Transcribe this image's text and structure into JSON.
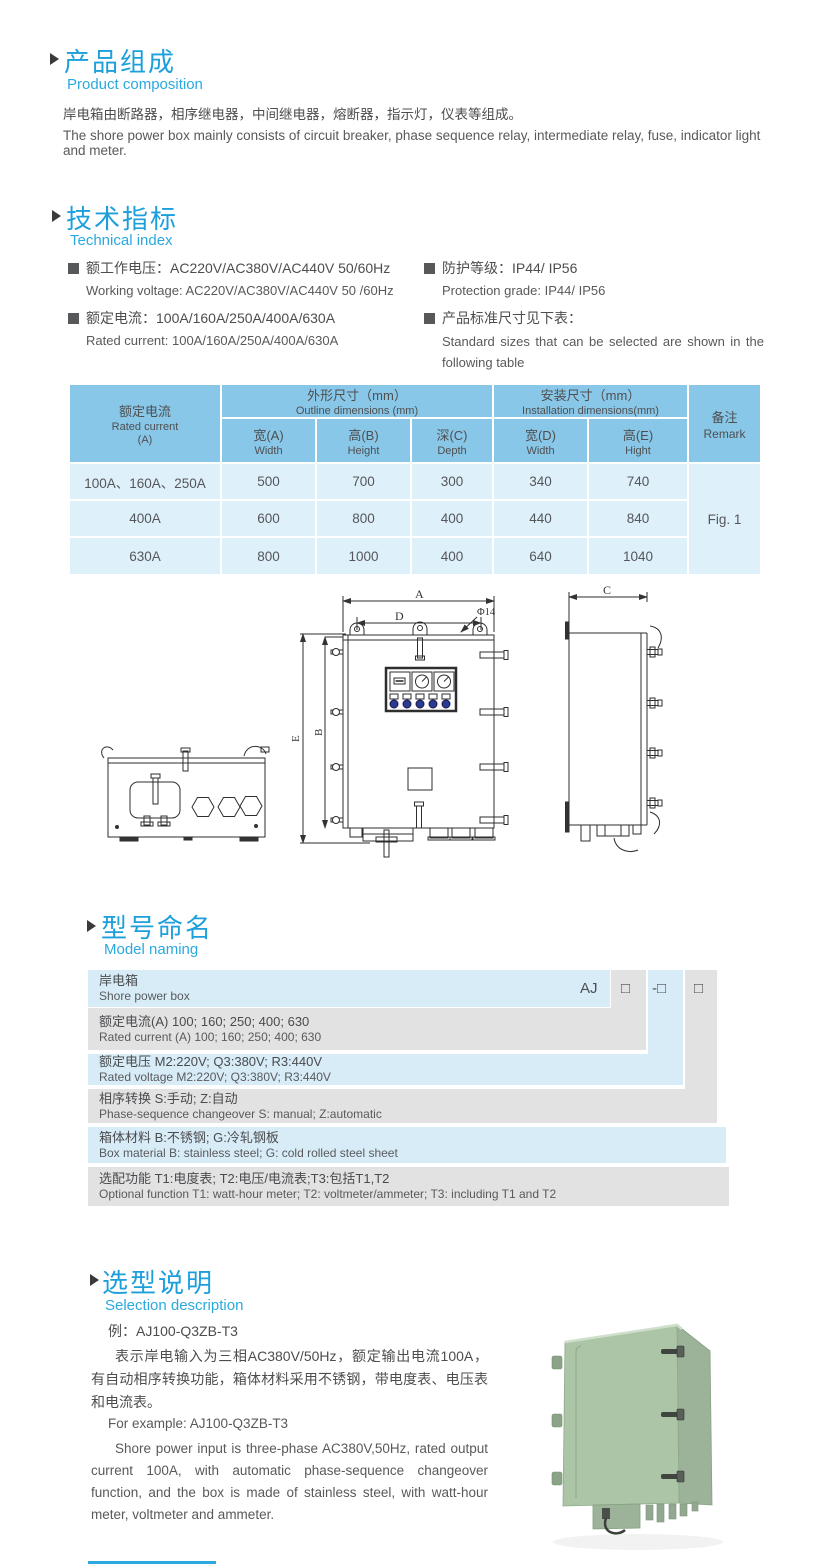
{
  "composition": {
    "title_cn": "产品组成",
    "title_en": "Product  composition",
    "body_cn": "岸电箱由断路器，相序继电器，中间继电器，熔断器，指示灯，仪表等组成。",
    "body_en": "The shore power box mainly consists of circuit breaker, phase sequence relay, intermediate relay, fuse, indicator light and meter."
  },
  "technical": {
    "title_cn": "技术指标",
    "title_en": "Technical index",
    "specs_left": [
      {
        "cn": "额工作电压：AC220V/AC380V/AC440V  50/60Hz",
        "en": "Working voltage: AC220V/AC380V/AC440V 50 /60Hz"
      },
      {
        "cn": "额定电流：100A/160A/250A/400A/630A",
        "en": "Rated current: 100A/160A/250A/400A/630A"
      }
    ],
    "specs_right": [
      {
        "cn": "防护等级：IP44/ IP56",
        "en": "Protection grade: IP44/ IP56"
      },
      {
        "cn": "产品标准尺寸见下表：",
        "en": "Standard  sizes  that  can  be  selected  are  shown  in  the following table"
      }
    ]
  },
  "size_table": {
    "rated_current_cn": "额定电流",
    "rated_current_en": "Rated current",
    "rated_current_unit": "(A)",
    "outline_cn": "外形尺寸（mm）",
    "outline_en": "Outline dimensions (mm)",
    "install_cn": "安装尺寸（mm）",
    "install_en": "Installation dimensions(mm)",
    "remark_cn": "备注",
    "remark_en": "Remark",
    "subcols": [
      {
        "cn": "宽(A)",
        "en": "Width"
      },
      {
        "cn": "高(B)",
        "en": "Height"
      },
      {
        "cn": "深(C)",
        "en": "Depth"
      },
      {
        "cn": "宽(D)",
        "en": "Width"
      },
      {
        "cn": "高(E)",
        "en": "Hight"
      }
    ],
    "rows": [
      [
        "100A、160A、250A",
        "500",
        "700",
        "300",
        "340",
        "740"
      ],
      [
        "400A",
        "600",
        "800",
        "400",
        "440",
        "840"
      ],
      [
        "630A",
        "800",
        "1000",
        "400",
        "640",
        "1040"
      ]
    ],
    "remark_value": "Fig. 1"
  },
  "drawing": {
    "dim_a": "A",
    "dim_b": "B",
    "dim_c": "C",
    "dim_d": "D",
    "dim_e": "E",
    "hole": "Φ14"
  },
  "model_naming": {
    "title_cn": "型号命名",
    "title_en": "Model naming",
    "code_prefix": "AJ",
    "code_box1": "□",
    "code_box2": "-□",
    "code_box3": "□",
    "rows": [
      {
        "cn": "岸电箱",
        "en": "Shore power box"
      },
      {
        "cn": "额定电流(A)  100; 160; 250; 400; 630",
        "en": "Rated current (A) 100; 160; 250; 400; 630"
      },
      {
        "cn": "额定电压   M2:220V;  Q3:380V;  R3:440V",
        "en": "Rated voltage  M2:220V;  Q3:380V;  R3:440V"
      },
      {
        "cn": "相序转换  S:手动; Z:自动",
        "en": "Phase-sequence changeover  S: manual;  Z:automatic"
      },
      {
        "cn": "箱体材料    B:不锈钢;  G:冷轧钢板",
        "en": "Box material   B: stainless steel; G: cold rolled steel sheet"
      },
      {
        "cn": "选配功能      T1:电度表;  T2:电压/电流表;T3:包括T1,T2",
        "en": "Optional function  T1: watt-hour meter; T2: voltmeter/ammeter; T3: including T1 and T2"
      }
    ]
  },
  "selection": {
    "title_cn": "选型说明",
    "title_en": "Selection description",
    "example_cn": "例：AJ100-Q3ZB-T3",
    "body_cn": "表示岸电输入为三相AC380V/50Hz，额定输出电流100A，有自动相序转换功能，箱体材料采用不锈钢，带电度表、电压表和电流表。",
    "example_en": "For example: AJ100-Q3ZB-T3",
    "body_en": "Shore power input is three-phase AC380V,50Hz, rated output current 100A, with automatic phase-sequence changeover function, and the box is made of stainless steel, with watt-hour meter, voltmeter and ammeter."
  }
}
